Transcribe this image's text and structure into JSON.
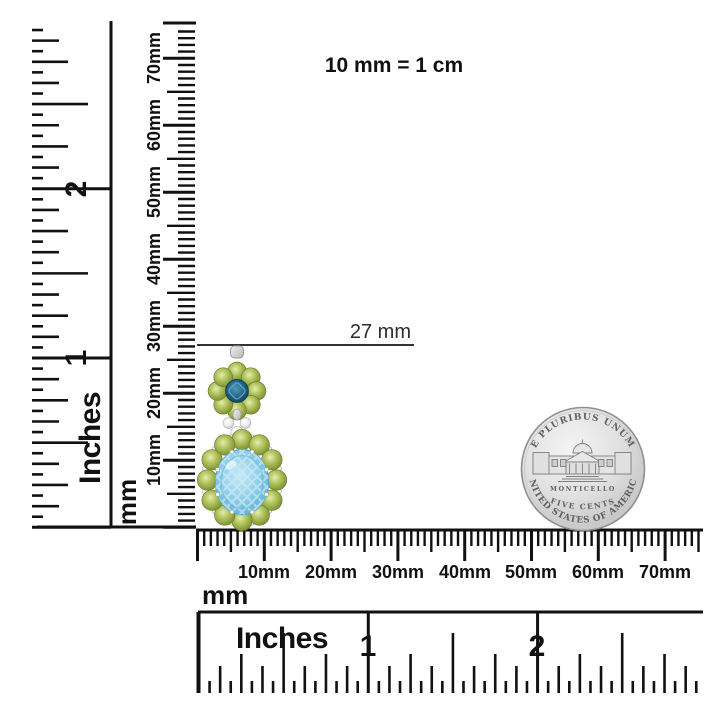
{
  "title_note": "10 mm = 1 cm",
  "annotation": {
    "length_label": "27 mm"
  },
  "rulers": {
    "vertical_mm": {
      "unit": "mm",
      "labels": [
        "10mm",
        "20mm",
        "30mm",
        "40mm",
        "50mm",
        "60mm",
        "70mm"
      ]
    },
    "vertical_inch": {
      "unit": "Inches",
      "labels": [
        "1",
        "2"
      ]
    },
    "horizontal_mm": {
      "unit": "mm",
      "labels": [
        "10mm",
        "20mm",
        "30mm",
        "40mm",
        "50mm",
        "60mm",
        "70mm"
      ]
    },
    "horizontal_inch": {
      "unit": "Inches",
      "labels": [
        "1",
        "2"
      ]
    }
  },
  "coin": {
    "motto": "E PLURIBUS UNUM",
    "building_name": "MONTICELLO",
    "denomination": "FIVE CENTS",
    "country": "UNITED STATES OF AMERICA"
  },
  "colors": {
    "ink": "#111111",
    "peridot_green": "#a6b94f",
    "sky_blue_topaz": "#8fd0ea",
    "london_blue_topaz": "#20637f",
    "silver": "#d9d9d9",
    "coin_silver": "#d3d3d3"
  }
}
